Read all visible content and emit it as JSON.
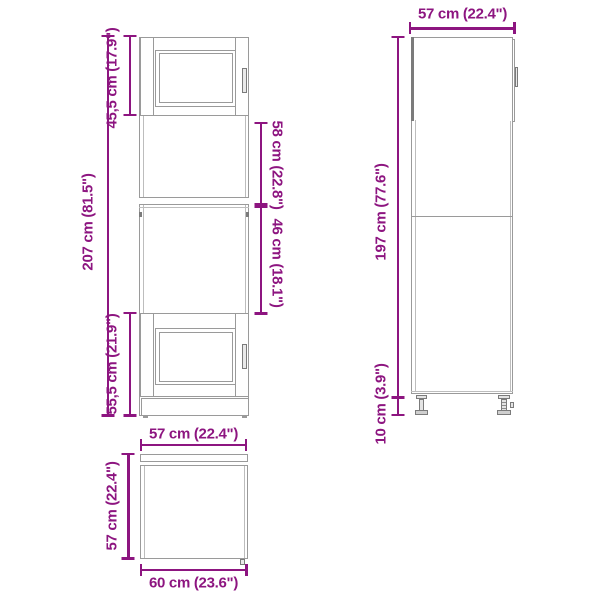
{
  "colors": {
    "dimension": "#8d1580",
    "line": "#9a9a9a",
    "line_light": "#bdbdbd",
    "line_dark": "#7b7b7b"
  },
  "dimensions": {
    "front": {
      "total_height": "207 cm (81.5\")",
      "top_door_height": "45,5 cm (17.9\")",
      "upper_opening_height": "58 cm (22.8\")",
      "lower_opening_height": "46 cm (18.1\")",
      "bottom_door_height": "55,5 cm (21.9\")"
    },
    "side": {
      "depth": "57 cm (22.4\")",
      "carcass_height": "197 cm (77.6\")",
      "leg_height": "10 cm (3.9\")"
    },
    "top": {
      "inner_width": "57 cm (22.4\")",
      "depth": "57 cm (22.4\")",
      "overall_width": "60 cm (23.6\")"
    }
  }
}
